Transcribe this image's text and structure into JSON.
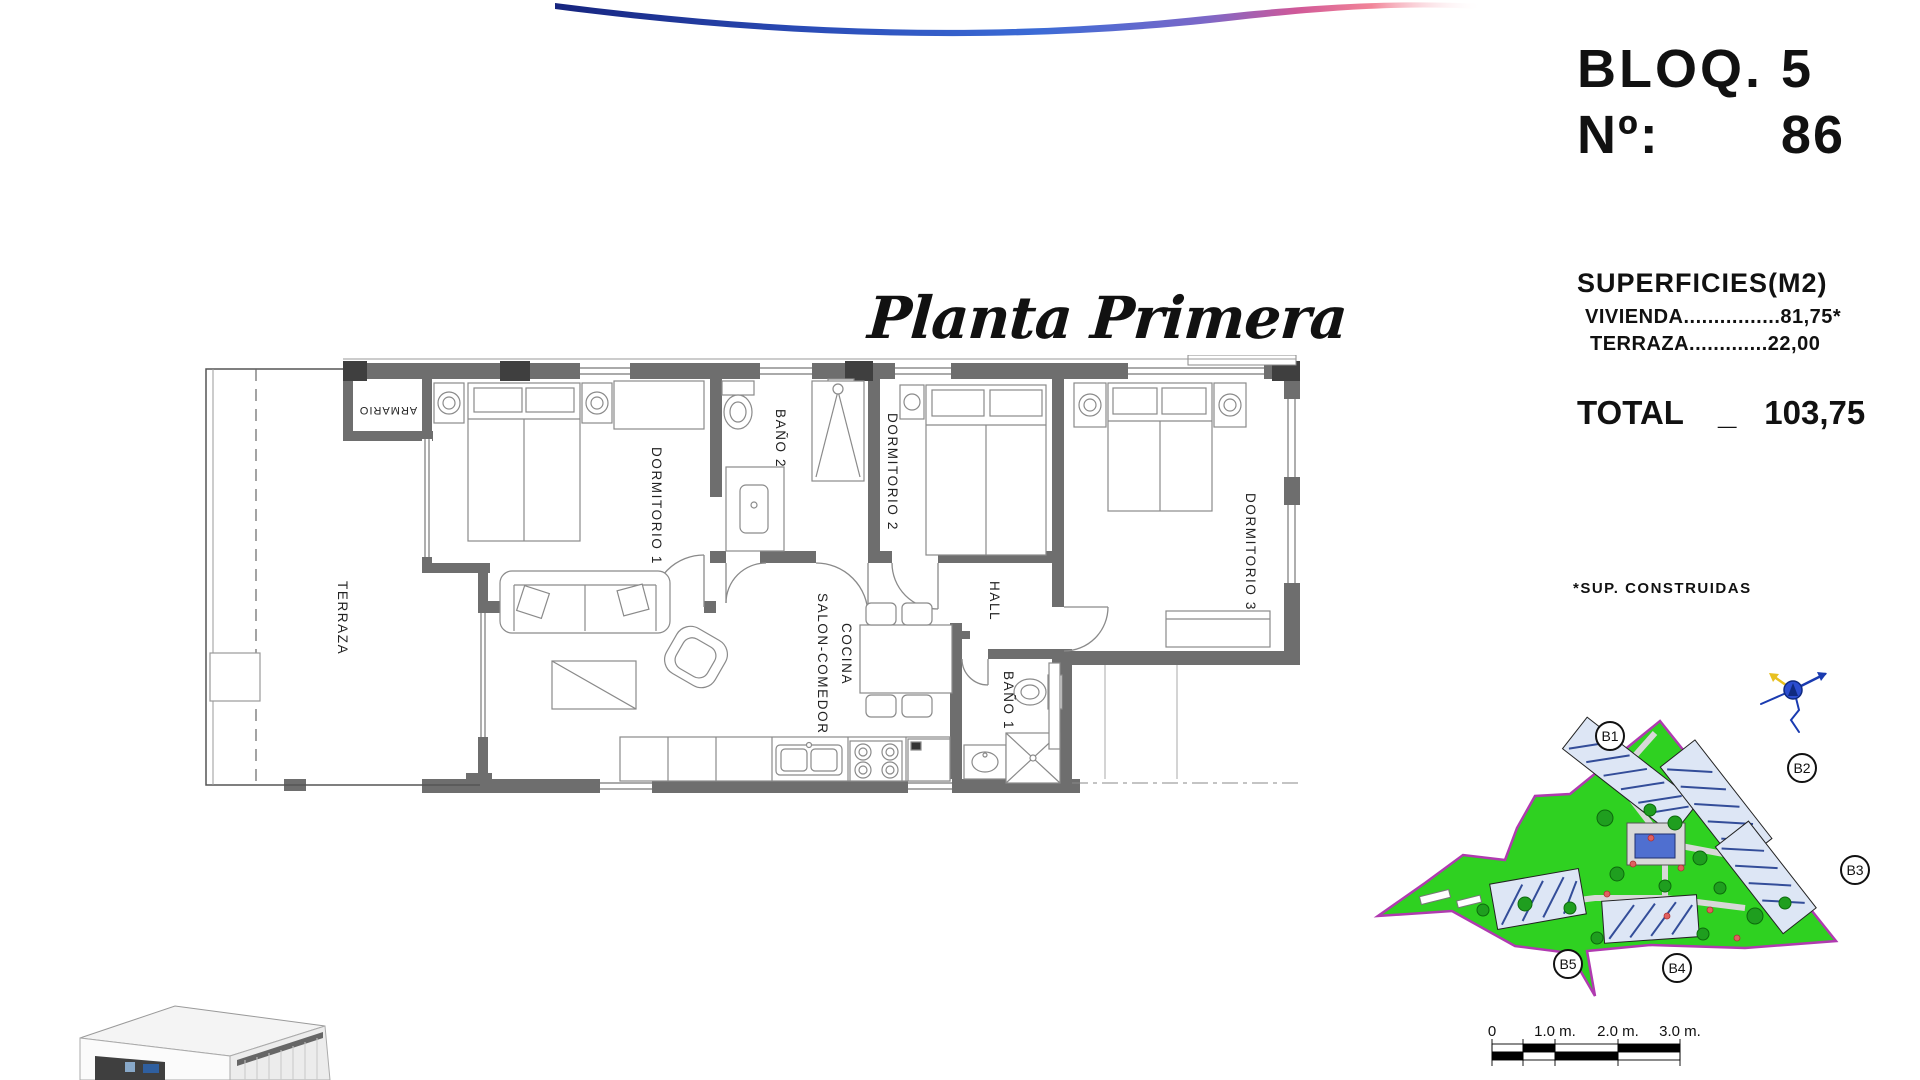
{
  "decor": {
    "swoosh_colors": [
      "#16247e",
      "#2b4db8",
      "#3b6bd6",
      "#7b68c8",
      "#d05898",
      "#ef6f86"
    ]
  },
  "unit_info": {
    "block": "BLOQ. 5",
    "number_label": "Nº:",
    "number_value": "86"
  },
  "surfaces": {
    "title": "SUPERFICIES(M2)",
    "rows": [
      {
        "label": "VIVIENDA",
        "dots": "................",
        "value": "81,75*"
      },
      {
        "label": "TERRAZA",
        "dots": ".............",
        "value": "22,00"
      }
    ],
    "total_label": "TOTAL",
    "total_separator": "_",
    "total_value": "103,75",
    "footnote": "*SUP. CONSTRUIDAS"
  },
  "plan": {
    "title": "Planta Primera",
    "rooms": [
      {
        "label": "TERRAZA"
      },
      {
        "label": "ARMARIO"
      },
      {
        "label": "DORMITORIO 1"
      },
      {
        "label": "BAÑO 2"
      },
      {
        "label": "DORMITORIO 2"
      },
      {
        "label": "DORMITORIO 3"
      },
      {
        "label": "SALON-COMEDOR"
      },
      {
        "label": "COCINA"
      },
      {
        "label": "HALL"
      },
      {
        "label": "BAÑO 1"
      }
    ]
  },
  "site_map": {
    "blocks": [
      {
        "label": "B1"
      },
      {
        "label": "B2"
      },
      {
        "label": "B3"
      },
      {
        "label": "B4"
      },
      {
        "label": "B5"
      }
    ],
    "colors": {
      "lawn": "#2fd121",
      "boundary": "#b03ab0",
      "pool": "#4f6fd0",
      "tree": "#1f9e1f",
      "building_hatch": "#334d99"
    }
  },
  "scale_bar": {
    "labels": [
      {
        "t": "0"
      },
      {
        "t": "1.0 m."
      },
      {
        "t": "2.0 m."
      },
      {
        "t": "3.0 m."
      }
    ]
  }
}
